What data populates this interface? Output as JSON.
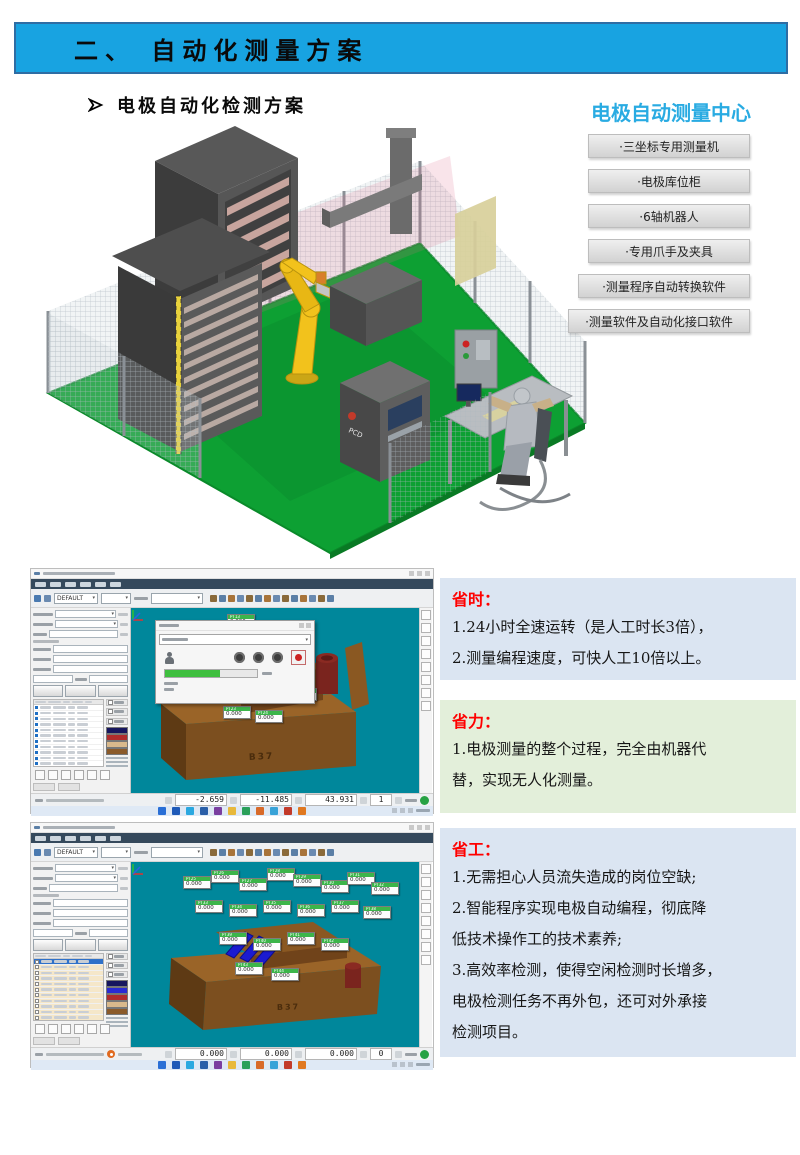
{
  "slide": {
    "banner_title": "二、 自动化测量方案",
    "section_heading": "电极自动化检测方案"
  },
  "measurement_center": {
    "title": "电极自动测量中心",
    "items": [
      "·三坐标专用测量机",
      "·电极库位柜",
      "·6轴机器人",
      "·专用爪手及夹具",
      "·测量程序自动转换软件",
      "·测量软件及自动化接口软件"
    ]
  },
  "benefits": {
    "time": {
      "heading": "省时：",
      "lines": [
        "1.24小时全速运转（是人工时长3倍），",
        "2.测量编程速度，可快人工10倍以上。"
      ]
    },
    "labor": {
      "heading": "省力：",
      "lines": [
        "1.电极测量的整个过程，完全由机器代",
        "替，实现无人化测量。"
      ]
    },
    "staff": {
      "heading": "省工：",
      "lines": [
        "1.无需担心人员流失造成的岗位空缺;",
        "2.智能程序实现电极自动编程，彻底降",
        "低技术操作工的技术素养;",
        "3.高效率检测，使得空闲检测时长增多，",
        "电极检测任务不再外包，还可对外承接",
        "检测项目。"
      ]
    }
  },
  "software_shots": {
    "shot1": {
      "probe_preset": "DEFAULT",
      "model_label": "B37",
      "status": {
        "x": "-2.659",
        "y": "-11.485",
        "z": "43.931",
        "count": "1"
      },
      "legend_colors": [
        "#16165e",
        "#b02c2c",
        "#d9b98c",
        "#8a5a2a"
      ],
      "points": [
        {
          "id": "PT13",
          "val": "0.000"
        },
        {
          "id": "PT14",
          "val": "0.000"
        },
        {
          "id": "PT15",
          "val": "0.000"
        },
        {
          "id": "PT16",
          "val": "0.000"
        },
        {
          "id": "PT17",
          "val": "0.000"
        },
        {
          "id": "PT18",
          "val": "0.000"
        },
        {
          "id": "PT19",
          "val": "0.000"
        },
        {
          "id": "PT20",
          "val": "0.000"
        },
        {
          "id": "PT21",
          "val": "0.000"
        },
        {
          "id": "PT22",
          "val": "0.000"
        },
        {
          "id": "PT23",
          "val": "0.000"
        },
        {
          "id": "PT24",
          "val": "0.000"
        }
      ]
    },
    "shot2": {
      "probe_preset": "DEFAULT",
      "model_label": "B37",
      "status": {
        "x": "0.000",
        "y": "0.000",
        "z": "0.000",
        "count": "0"
      },
      "legend_colors": [
        "#16165e",
        "#2a2ad2",
        "#b02c2c",
        "#d9b98c",
        "#8a5a2a"
      ],
      "points": [
        {
          "id": "PT25",
          "val": "0.000"
        },
        {
          "id": "PT26",
          "val": "0.000"
        },
        {
          "id": "PT27",
          "val": "0.000"
        },
        {
          "id": "PT28",
          "val": "0.000"
        },
        {
          "id": "PT29",
          "val": "0.000"
        },
        {
          "id": "PT30",
          "val": "0.000"
        },
        {
          "id": "PT31",
          "val": "0.000"
        },
        {
          "id": "PT32",
          "val": "0.000"
        },
        {
          "id": "PT33",
          "val": "0.000"
        },
        {
          "id": "PT34",
          "val": "0.000"
        },
        {
          "id": "PT35",
          "val": "0.000"
        },
        {
          "id": "PT36",
          "val": "0.000"
        },
        {
          "id": "PT37",
          "val": "0.000"
        },
        {
          "id": "PT38",
          "val": "0.000"
        },
        {
          "id": "PT39",
          "val": "0.000"
        },
        {
          "id": "PT40",
          "val": "0.000"
        },
        {
          "id": "PT41",
          "val": "0.000"
        },
        {
          "id": "PT42",
          "val": "0.000"
        },
        {
          "id": "PT43",
          "val": "0.000"
        },
        {
          "id": "PT44",
          "val": "0.000"
        }
      ]
    }
  },
  "taskbar": {
    "icon_colors": [
      "#2a6fd6",
      "#1f5ab8",
      "#2aa8e0",
      "#2a5fa8",
      "#7a3fa0",
      "#e8b93c",
      "#2aa05a",
      "#d86a2a",
      "#38a3d8",
      "#c23a2a",
      "#e07820"
    ]
  },
  "colors": {
    "banner_bg": "#18A3E1",
    "banner_border": "#2E6DA4",
    "center_title": "#29ABE2",
    "benefit_heading": "#FF0000",
    "benefit_blue_bg": "#DBE5F2",
    "benefit_green_bg": "#E3EFDA",
    "viewport_bg": "#00879B",
    "floor_green": "#0DA033",
    "robot_yellow": "#F2C21C",
    "point_label_green": "#3CB54A"
  }
}
